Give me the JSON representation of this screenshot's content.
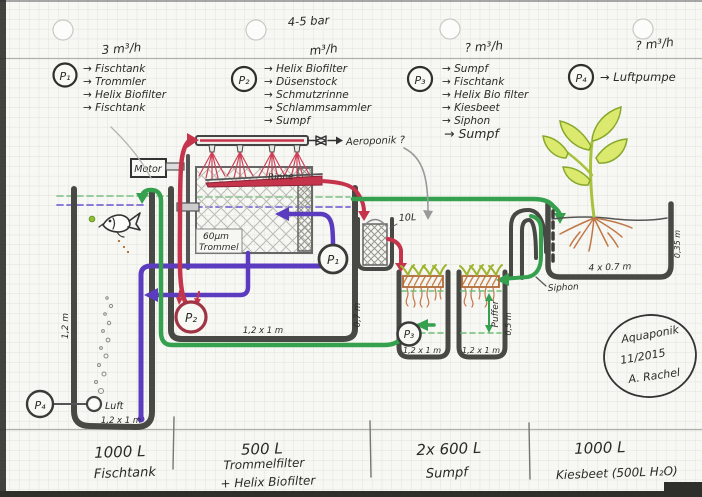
{
  "header": {
    "pressure": "4-5 bar",
    "pumps": [
      {
        "label": "P₁",
        "flow": "3 m³/h",
        "items": [
          "→ Fischtank",
          "→ Trommler",
          "→ Helix Biofilter",
          "→ Fischtank"
        ]
      },
      {
        "label": "P₂",
        "flow": "m³/h",
        "items": [
          "→ Helix Biofilter",
          "→ Düsenstock",
          "→ Schmutzrinne",
          "→ Schlammsammler",
          "→ Sumpf"
        ]
      },
      {
        "label": "P₃",
        "flow": "? m³/h",
        "items": [
          "→ Sumpf",
          "→ Fischtank",
          "→ Helix Bio filter",
          "→ Kiesbeet",
          "→ Siphon",
          "→ Sumpf"
        ]
      },
      {
        "label": "P₄",
        "flow": "? m³/h",
        "items": [
          "→ Luftpumpe"
        ]
      }
    ]
  },
  "diagram": {
    "pump1": "P₁",
    "pump2": "P₂",
    "pump3": "P₃",
    "pump4": "P₄",
    "motor": "Motor",
    "rinne": "Rinne",
    "trommel_micron": "60μm",
    "trommel_word": "Trommel",
    "aeroponik": "Aeroponik ?",
    "canister_volume": "10L",
    "siphon": "Siphon",
    "air_stone": "Luft",
    "puffer": "Puffer",
    "dim_fish_height": "1,2 m",
    "dim_fish_base": "1,2 x 1 m",
    "dim_trommel_base": "1,2 x 1 m",
    "dim_trommel_height": "0,7 m",
    "dim_sump1_base": "1,2 x 1 m",
    "dim_sump2_base": "1,2 x 1 m",
    "dim_sump_height": "0,5 m",
    "dim_bed_base": "4 x 0.7 m",
    "dim_bed_height": "0,35 m"
  },
  "footer": {
    "sections": [
      {
        "volume": "1000 L",
        "name": "Fischtank"
      },
      {
        "volume": "500 L",
        "name": "Trommelfilter",
        "name2": "+ Helix Biofilter"
      },
      {
        "volume": "2x 600 L",
        "name": "Sumpf"
      },
      {
        "volume": "1000 L",
        "name": "Kiesbeet (500L H₂O)"
      }
    ]
  },
  "stamp": {
    "project": "Aquaponik",
    "date": "11/2015",
    "author": "A. Rachel"
  },
  "colors": {
    "pipe_red": "#c6344c",
    "pipe_purple": "#5b3bbf",
    "pipe_green": "#35a14f",
    "wall_ink": "#484844",
    "roots": "#c07848",
    "leaf_fill": "#dce96f"
  }
}
